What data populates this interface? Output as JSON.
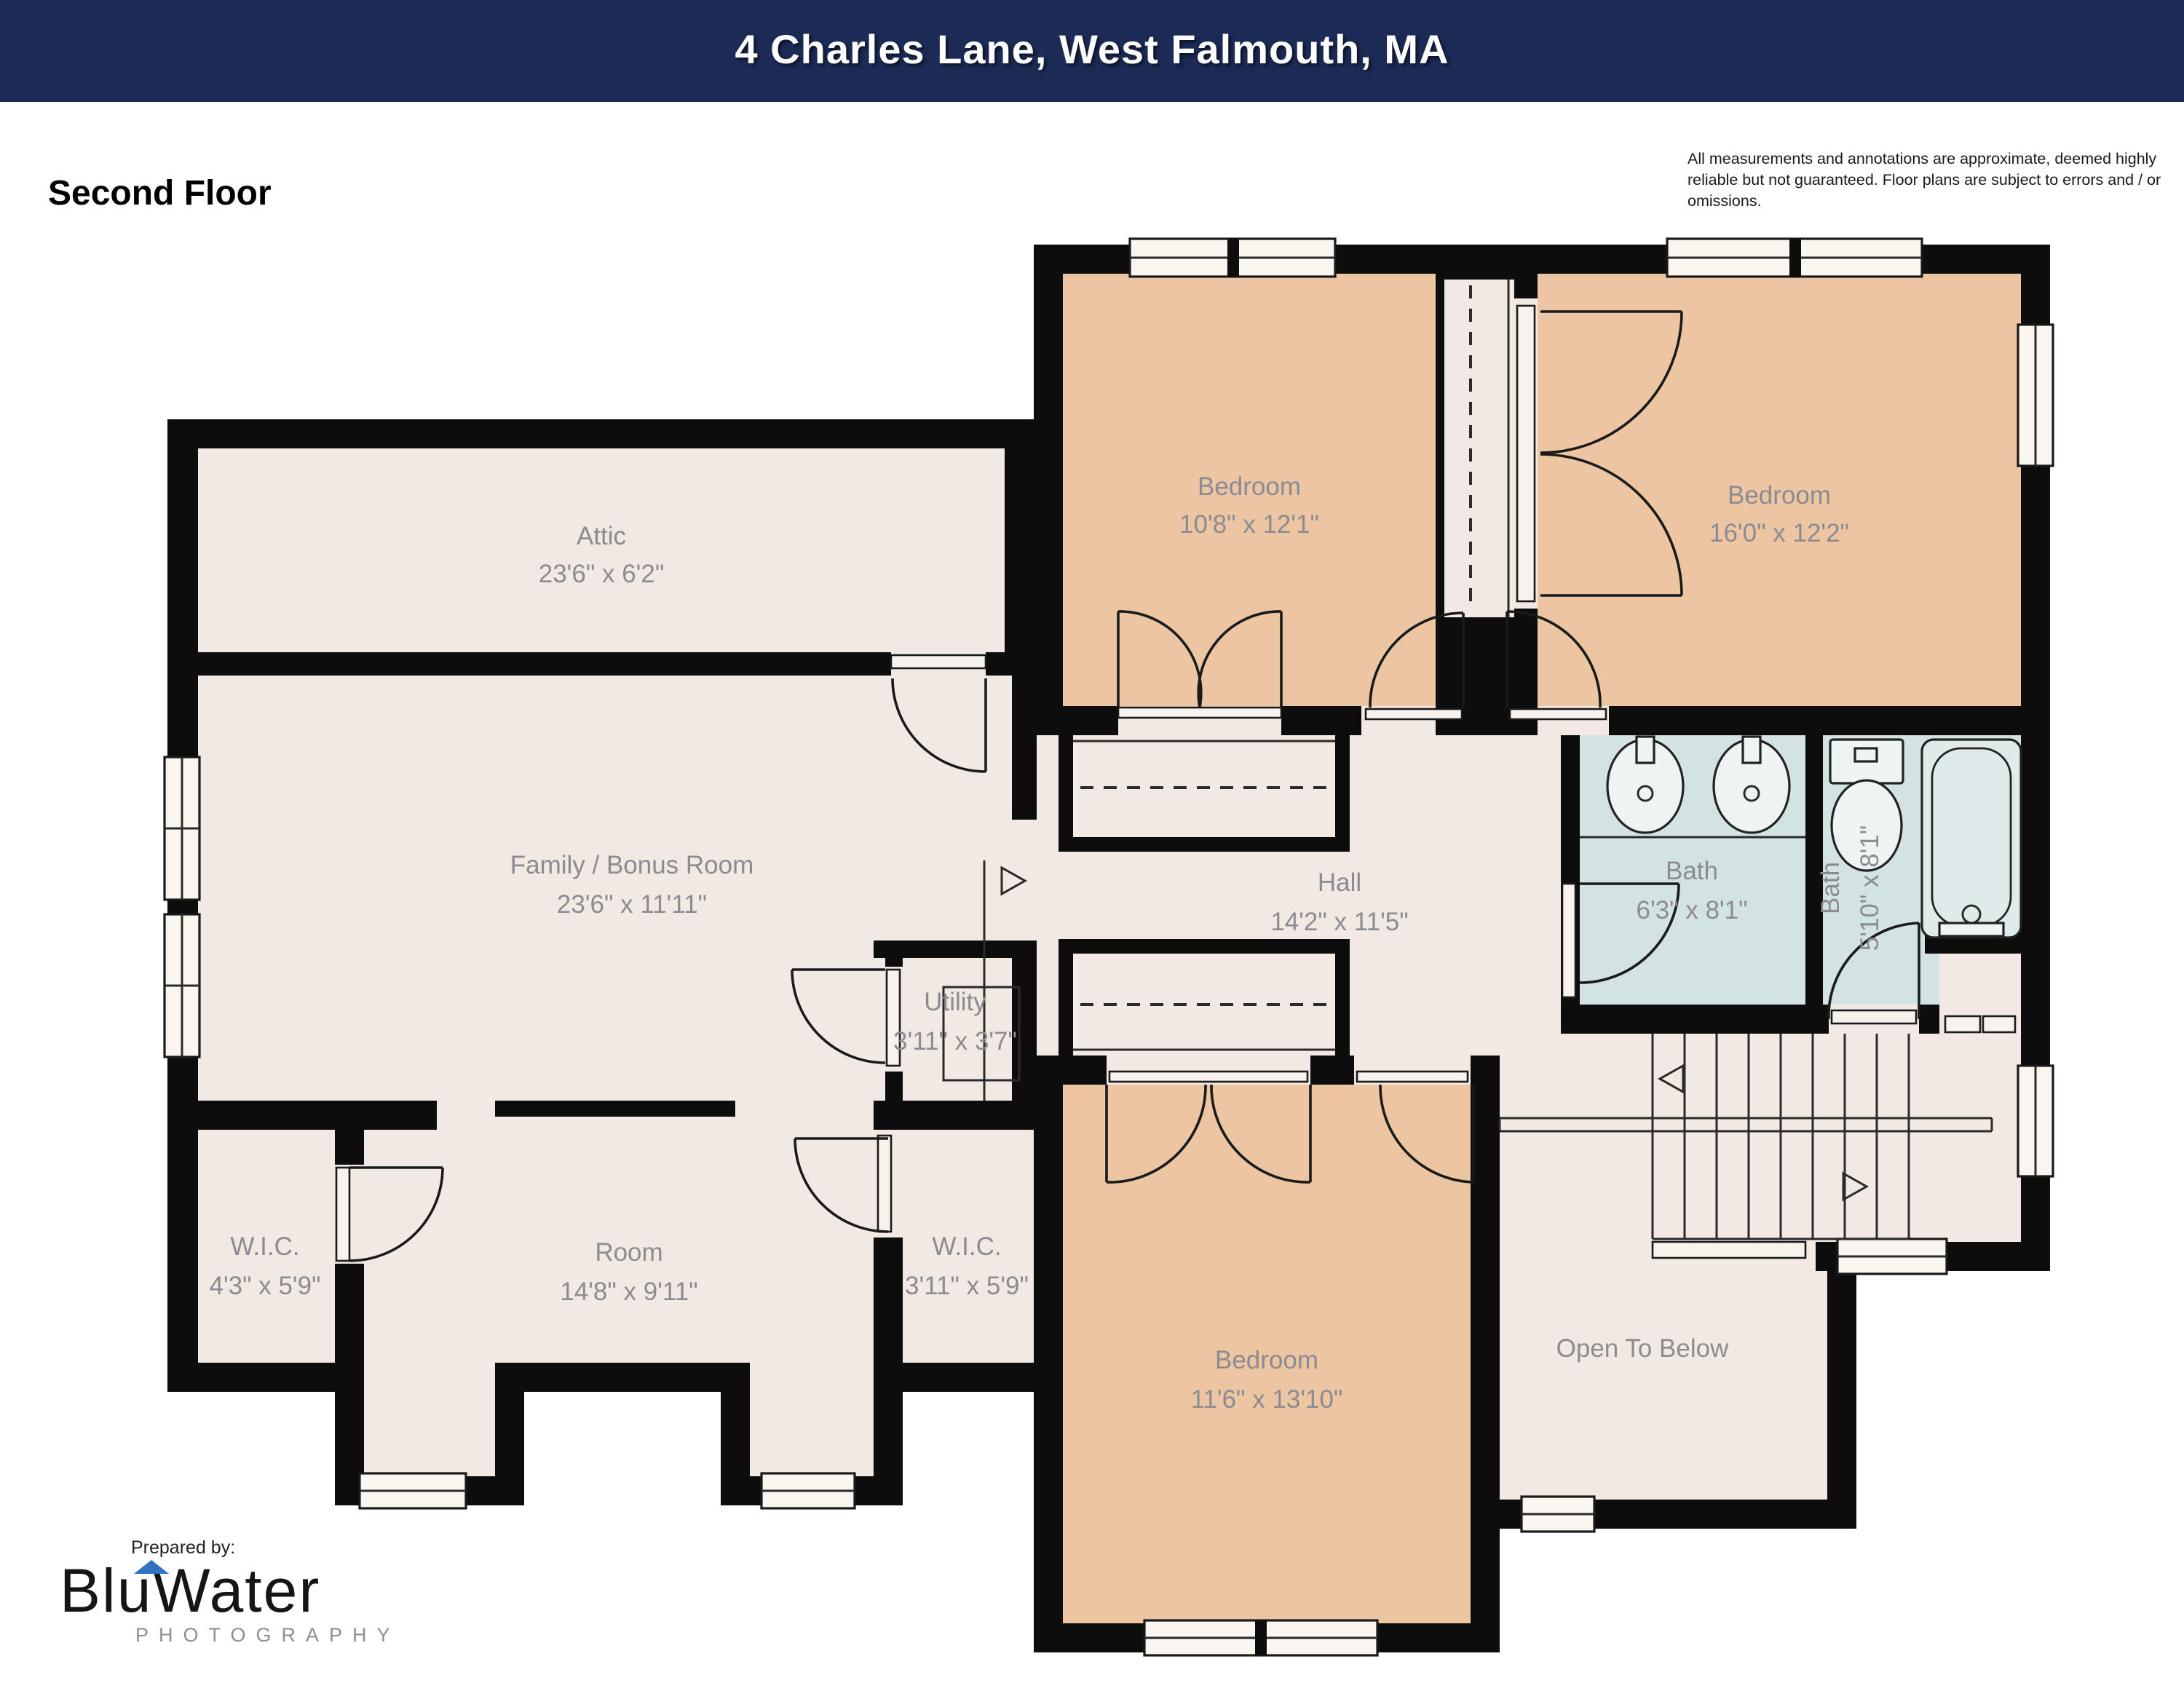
{
  "header": {
    "title": "4 Charles Lane, West Falmouth, MA"
  },
  "meta": {
    "floor_label": "Second Floor",
    "disclaimer": "All measurements and annotations are approximate, deemed highly reliable but not guaranteed. Floor plans are subject to errors and / or omissions.",
    "prepared_by": "Prepared by:"
  },
  "logo": {
    "brand_part1": "Blu",
    "brand_part2": "Water",
    "subtitle": "PHOTOGRAPHY"
  },
  "rooms": {
    "attic": {
      "name": "Attic",
      "dims": "23'6\" x 6'2\""
    },
    "bedroom_top_left": {
      "name": "Bedroom",
      "dims": "10'8\" x 12'1\""
    },
    "bedroom_top_right": {
      "name": "Bedroom",
      "dims": "16'0\" x 12'2\""
    },
    "family_bonus": {
      "name": "Family / Bonus Room",
      "dims": "23'6\" x 11'11\""
    },
    "hall": {
      "name": "Hall",
      "dims": "14'2\" x 11'5\""
    },
    "bath_main": {
      "name": "Bath",
      "dims": "6'3\" x 8'1\""
    },
    "bath_second": {
      "name": "Bath",
      "dims": "5'10\" x 8'1\""
    },
    "utility": {
      "name": "Utility",
      "dims": "3'11\" x 3'7\""
    },
    "wic_left": {
      "name": "W.I.C.",
      "dims": "4'3\" x 5'9\""
    },
    "room": {
      "name": "Room",
      "dims": "14'8\" x 9'11\""
    },
    "wic_right": {
      "name": "W.I.C.",
      "dims": "3'11\" x 5'9\""
    },
    "bedroom_bottom": {
      "name": "Bedroom",
      "dims": "11'6\" x 13'10\""
    },
    "open_to_below": {
      "name": "Open To Below",
      "dims": ""
    }
  },
  "colors": {
    "header_bg": "#1c2a56",
    "bedroom_fill": "#ecc5a3",
    "room_fill": "#f2e9e2",
    "bath_fill": "#d3e2e3",
    "wall": "#0d0d0d",
    "label_text": "#8b8b91",
    "logo_accent": "#2e74c0"
  }
}
